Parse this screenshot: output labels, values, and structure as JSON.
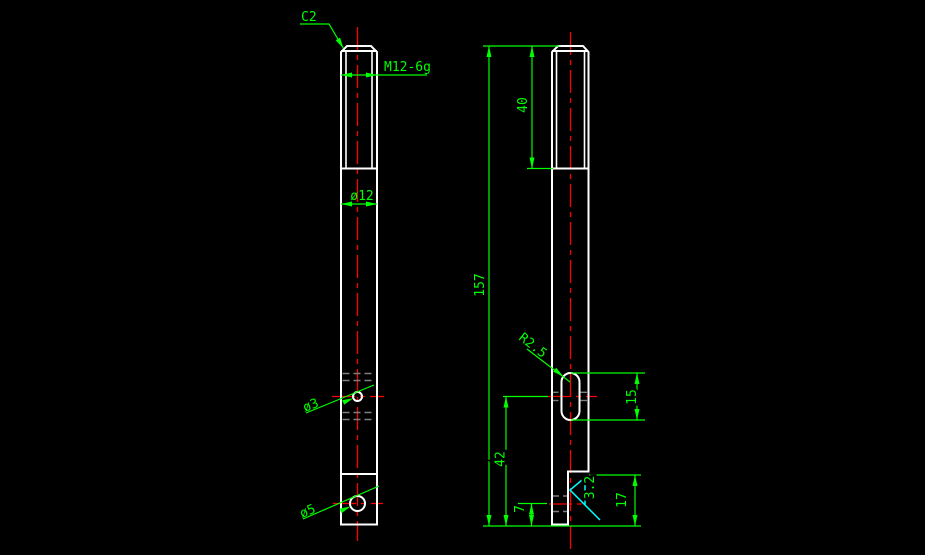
{
  "drawing": {
    "colors": {
      "background": "#000000",
      "outline": "#ffffff",
      "dimension": "#00ff00",
      "centerline": "#ff0000",
      "hidden": "#7f7f7f",
      "surface_finish": "#00ffff"
    },
    "front_view": {
      "chamfer_label": "C2",
      "thread_label": "M12-6g",
      "diameter_label": "ø12",
      "small_hole_label": "ø3",
      "large_hole_label": "ø5"
    },
    "side_view": {
      "thread_length": "40",
      "overall_length": "157",
      "slot_radius_label": "R2.5",
      "slot_length": "15",
      "slot_center_to_bottom": "42",
      "hole_center_to_bottom": "7",
      "flat_length": "17",
      "surface_roughness": "3.2"
    }
  }
}
